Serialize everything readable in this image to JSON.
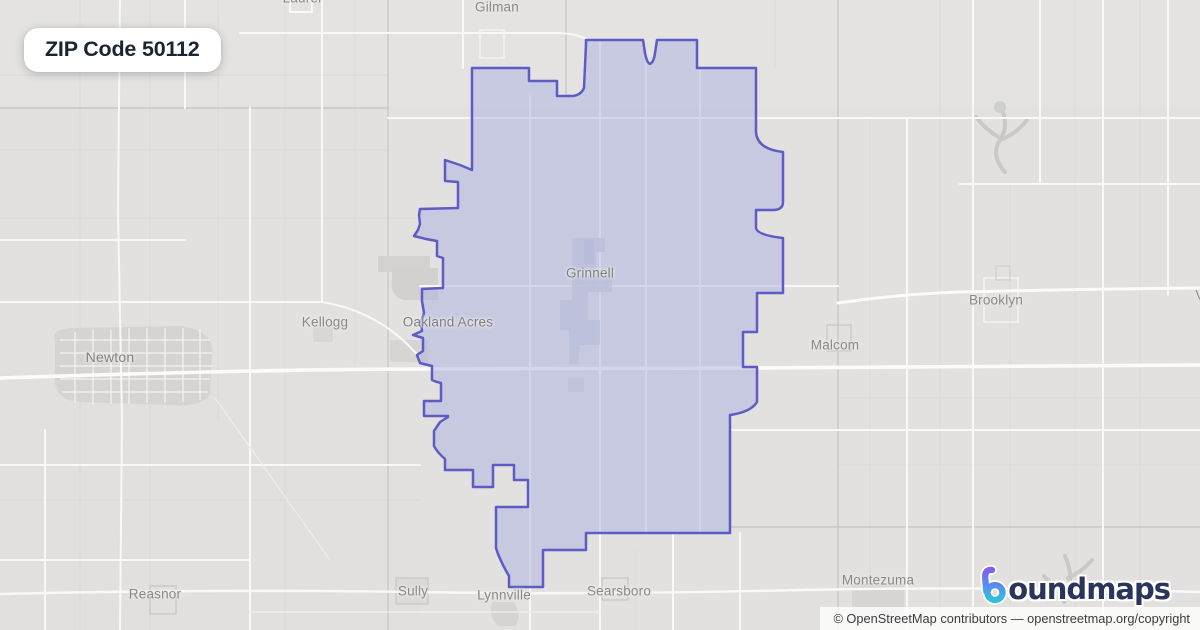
{
  "badge": {
    "label": "ZIP Code 50112"
  },
  "map": {
    "labels": [
      {
        "id": "laurel",
        "text": "Laurel"
      },
      {
        "id": "gilman",
        "text": "Gilman"
      },
      {
        "id": "kellogg",
        "text": "Kellogg"
      },
      {
        "id": "oakland-acres",
        "text": "Oakland Acres"
      },
      {
        "id": "newton",
        "text": "Newton"
      },
      {
        "id": "grinnell",
        "text": "Grinnell"
      },
      {
        "id": "brooklyn",
        "text": "Brooklyn"
      },
      {
        "id": "malcom",
        "text": "Malcom"
      },
      {
        "id": "reasnor",
        "text": "Reasnor"
      },
      {
        "id": "sully",
        "text": "Sully"
      },
      {
        "id": "lynnville",
        "text": "Lynnville"
      },
      {
        "id": "searsboro",
        "text": "Searsboro"
      },
      {
        "id": "montezuma",
        "text": "Montezuma"
      },
      {
        "id": "victor-partial",
        "text": "V"
      }
    ],
    "zip_region": "50112"
  },
  "logo": {
    "brand_suffix": "oundmaps",
    "icon": "boundmaps-b-pin-icon"
  },
  "attribution": {
    "prefix": "© OpenStreetMap contributors — ",
    "link": "openstreetmap.org/copyright"
  },
  "colors": {
    "boundary_stroke": "#5f5bc5",
    "boundary_fill": "rgba(172,178,226,0.5)",
    "map_background": "#e2e1df",
    "badge_text": "#1b2433",
    "logo_navy": "#2b355c",
    "logo_purple": "#8455ef",
    "logo_teal": "#27ccd6"
  }
}
